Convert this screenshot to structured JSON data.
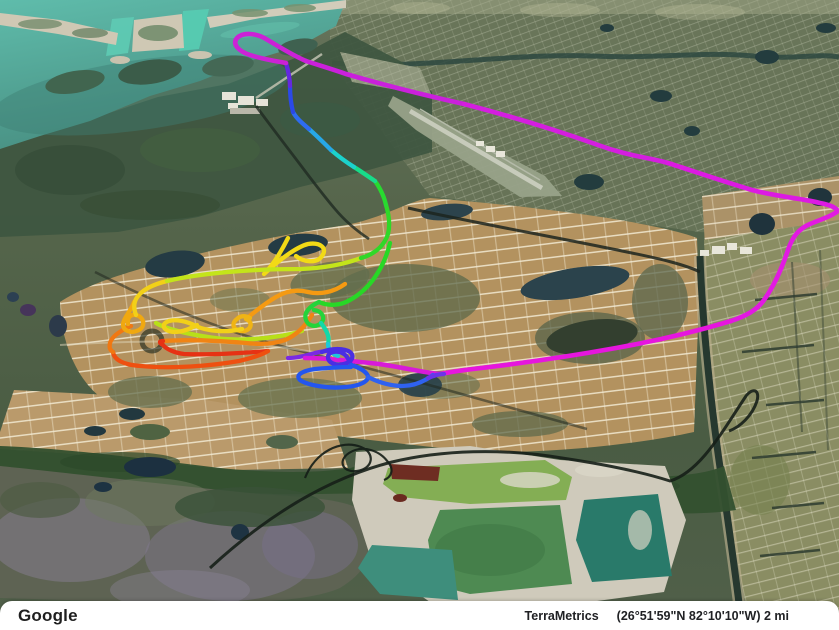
{
  "meta": {
    "app": "google-earth-3d-view",
    "description": "Tilted 3D satellite view of coastal Florida neighborhood grids with a multicolor GPS flight track overlay"
  },
  "attribution": {
    "logo": "Google",
    "credit": "TerraMetrics",
    "coords": "(26°51'59\"N 82°10'10\"W)",
    "scale": "2 mi"
  },
  "flight_track": {
    "default_width": 4.3,
    "colors_used": [
      "#e63214",
      "#ee5010",
      "#f08414",
      "#f0a810",
      "#f2d018",
      "#c4e41a",
      "#30d828",
      "#18dc8a",
      "#1cd2cc",
      "#27a8e8",
      "#2b49e8",
      "#6428e0",
      "#cc22d6",
      "#e616de"
    ],
    "segments": [
      {
        "name": "chartreuse-low-arc",
        "color": "#b8e018",
        "d": "M 302,331 C 275,339 238,342 208,337 C 188,334 166,329 156,323"
      },
      {
        "name": "orange-mid",
        "color": "#f59a12",
        "d": "M 345,284 C 334,292 320,295 308,292 C 296,289 286,291 276,297 C 264,304 252,314 246,319"
      },
      {
        "name": "gold-loop",
        "color": "#f0b414",
        "d": "M 246,319 C 253,322 252,329 244,331 C 234,332 230,324 237,319 C 241,315 246,316 250,318"
      },
      {
        "name": "gold-west-flat-loop",
        "color": "#f2d018",
        "d": "M 242,329 C 226,333 206,331 196,326 C 186,321 176,319 169,321 C 160,324 163,331 174,332 C 184,332 191,328 197,325"
      },
      {
        "name": "yellow-teardrop",
        "color": "#f2da16",
        "d": "M 288,238 C 282,250 274,264 264,274 C 278,261 296,247 308,244 C 320,242 328,248 322,256 C 317,264 303,262 296,256"
      },
      {
        "name": "orange-east",
        "color": "#f08414",
        "d": "M 163,341 C 190,339 222,341 246,343 C 264,345 277,343 285,340 C 297,335 306,325 312,315"
      },
      {
        "name": "red-west",
        "color": "#e63214",
        "d": "M 268,351 C 244,353 208,355 184,354 C 175,353 166,349 163,345 C 159,343 159,341 163,341"
      },
      {
        "name": "orange-red-bottom",
        "color": "#ee5010",
        "d": "M 113,352 C 114,360 124,365 141,366 C 171,369 211,366 239,361 C 252,358 262,355 268,351"
      },
      {
        "name": "orange-c-left",
        "color": "#f07812",
        "d": "M 131,326 C 122,330 112,336 110,343 C 109,348 110,350 113,352"
      },
      {
        "name": "gold-curl",
        "color": "#f0a810",
        "d": "M 134,302 C 131,311 124,317 123,324 C 123,331 131,334 139,330 C 146,326 144,317 136,315 C 130,314 127,318 128,324"
      },
      {
        "name": "yellow-ellipse-curl",
        "color": "#f2d018",
        "d": "M 136,315 C 133,307 134,300 139,295 C 145,288 155,284 167,281"
      },
      {
        "name": "chartreuse-ellipse-top",
        "color": "#c4e41a",
        "d": "M 167,281 C 201,273 251,269 301,269 C 325,268 345,264 361,258"
      },
      {
        "name": "green-apex",
        "color": "#30d828",
        "d": "M 361,258 C 375,254 384,246 388,234 C 390,226 389,215 386,205"
      },
      {
        "name": "green-up",
        "color": "#28da30",
        "d": "M 386,205 C 384,196 380,188 375,181"
      },
      {
        "name": "spring-up",
        "color": "#18dc8a",
        "d": "M 375,181 C 369,177 362,172 354,167"
      },
      {
        "name": "cyan-up",
        "color": "#1cd2cc",
        "d": "M 354,167 C 346,162 338,156 331,150"
      },
      {
        "name": "skyblue-up",
        "color": "#27a8e8",
        "d": "M 331,150 C 324,143 317,136 309,129"
      },
      {
        "name": "blue-kink",
        "color": "#2e6cf0",
        "d": "M 309,129 C 302,123 296,118 293,112"
      },
      {
        "name": "blue-vert",
        "color": "#2b49e8",
        "d": "M 293,112 C 291,104 290,96 290,86"
      },
      {
        "name": "violet-vert",
        "color": "#6428e0",
        "d": "M 290,86 C 290,78 288,70 286,63"
      },
      {
        "name": "magenta-loop",
        "color": "#cc22d6",
        "width": 4.6,
        "d": "M 306,61 C 292,55 278,46 266,39 C 256,33 243,32 237,38 C 232,44 238,51 250,55 C 262,59 275,61 286,63"
      },
      {
        "name": "magenta-a1",
        "color": "#ca20dc",
        "width": 4.6,
        "d": "M 306,61 C 318,65 332,69 346,74 C 384,85 424,95 464,104"
      },
      {
        "name": "magenta-a2",
        "color": "#d41edf",
        "width": 4.6,
        "d": "M 464,104 C 510,116 556,130 598,145 C 628,156 646,157 668,163"
      },
      {
        "name": "magenta-a3",
        "color": "#dc1ae2",
        "width": 4.6,
        "d": "M 668,163 C 690,170 722,181 752,190 C 778,197 800,198 820,203 C 830,205 835,207 838,211"
      },
      {
        "name": "magenta-hairpin",
        "color": "#e219e2",
        "width": 4.6,
        "d": "M 838,211 C 832,216 822,219 810,224 C 798,229 792,238 788,250 C 782,268 774,286 764,300 C 757,310 746,316 731,321"
      },
      {
        "name": "magenta-b1",
        "color": "#e616de",
        "width": 4.6,
        "d": "M 731,321 C 701,330 661,340 616,348 C 566,357 516,364 473,369 C 456,371 446,373 439,374"
      },
      {
        "name": "violet-end",
        "color": "#7a2ae2",
        "d": "M 288,358 C 296,358 305,356 315,353 C 323,351 331,350 337,351"
      },
      {
        "name": "magenta-b2",
        "color": "#d81ad8",
        "width": 4.6,
        "d": "M 439,374 C 421,372 401,367 379,364 C 361,362 343,360 327,359 C 317,358 311,358 305,358"
      },
      {
        "name": "green-arc",
        "color": "#28d826",
        "d": "M 390,243 C 384,268 370,289 350,300 C 340,306 328,306 319,302"
      },
      {
        "name": "green-hook",
        "color": "#24d43a",
        "d": "M 319,302 C 310,306 303,313 306,320 C 308,326 316,328 321,323 C 326,318 322,311 314,310"
      },
      {
        "name": "spring-down",
        "color": "#12d8a8",
        "d": "M 321,323 C 327,331 330,337 328,344"
      },
      {
        "name": "cyan-down",
        "color": "#1cc8dc",
        "d": "M 328,344 C 328,349 332,354 338,356"
      },
      {
        "name": "indigo-curl",
        "color": "#4a2ee4",
        "d": "M 322,352 C 332,348 344,348 350,352 C 355,356 352,362 344,364 C 336,366 328,363 328,357 C 328,352 336,350 342,353 C 347,355 349,360 351,365"
      },
      {
        "name": "blue-loop",
        "color": "#2456ee",
        "d": "M 351,365 C 358,367 366,371 368,376 C 369,381 360,386 346,387 C 328,389 307,385 300,380 C 295,375 302,371 315,369 C 327,368 341,367 351,367"
      },
      {
        "name": "blue-out",
        "color": "#2f62f0",
        "d": "M 368,377 C 378,382 390,386 402,386 C 415,386 425,381 433,375"
      },
      {
        "name": "purple-tail",
        "color": "#6c35e6",
        "d": "M 428,378 C 433,376 438,374 444,374"
      }
    ]
  }
}
